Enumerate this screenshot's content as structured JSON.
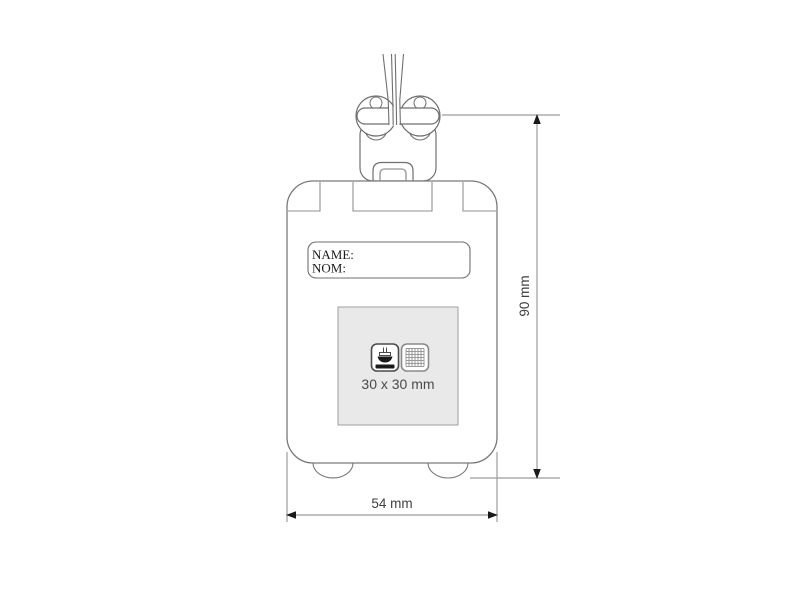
{
  "diagram": {
    "tag": {
      "name_line_1": "NAME:",
      "name_line_2": "NOM:"
    },
    "print_area": {
      "label": "30 x 30 mm",
      "methods": [
        "pad-print",
        "screen-print"
      ]
    },
    "dimensions": {
      "height": "90 mm",
      "width": "54 mm"
    },
    "colors": {
      "outline": "#6f6f6f",
      "light_line": "#a6a6a6",
      "dimension_line": "#9c9c9c",
      "arrow": "#1a1a1a",
      "print_area_fill": "#e9e9e9",
      "icon_dark": "#1a1a1a",
      "text": "#3f3f3f",
      "background": "#ffffff"
    }
  }
}
